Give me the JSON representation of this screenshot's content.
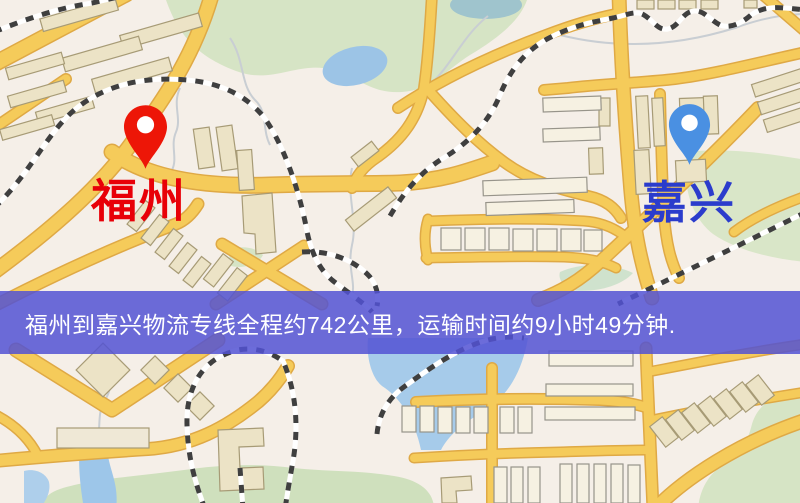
{
  "banner": {
    "text": "福州到嘉兴物流专线全程约742公里，运输时间约9小时49分钟."
  },
  "markers": {
    "origin": {
      "label": "福州"
    },
    "destination": {
      "label": "嘉兴"
    }
  },
  "colors": {
    "origin_pin": "#ed1607",
    "origin_label": "#e80008",
    "destination_pin": "#4a90e2",
    "destination_label": "#2b3ccc",
    "banner_background": "#5252d4",
    "banner_text": "#ffffff",
    "road": "#f5cb5a",
    "road_casing": "#dfa945",
    "park": "#d6e4c5",
    "water": "#a6cbea",
    "building": "#ece3c6",
    "railway": "#3f3f3f"
  }
}
